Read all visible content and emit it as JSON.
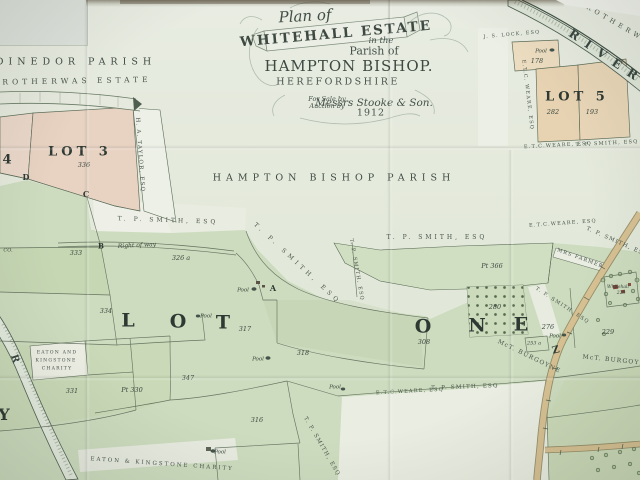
{
  "cartouche": {
    "plan_of": "Plan of",
    "estate_name": "WHITEHALL ESTATE",
    "in_the": "in the",
    "parish_of": "Parish of",
    "parish_name": "HAMPTON BISHOP.",
    "county": "HEREFORDSHIRE",
    "sale_line1": "For Sale by",
    "sale_line2": "Auction by",
    "auctioneers": "Messrs Stooke & Son.",
    "year": "1912"
  },
  "colors": {
    "paper": "#e5ebdf",
    "field_green": "#cddcbf",
    "parcel_pink": "#e8d2c2",
    "parcel_tan": "#e7d3b2",
    "road_tan": "#d7c193",
    "river_edge": "#4e5e50",
    "ink": "#3f4b43",
    "building_red": "#7b4335"
  },
  "labels": [
    {
      "t": "DINEDOR PARISH",
      "x": 76,
      "y": 62,
      "c": "region",
      "n": "dinedor-parish-label"
    },
    {
      "t": "ROTHERWAS ESTATE",
      "x": 77,
      "y": 81,
      "r": -1,
      "c": "estate",
      "n": "rotherwas-estate-label"
    },
    {
      "t": "HAMPTON BISHOP PARISH",
      "x": 334,
      "y": 178,
      "c": "region",
      "n": "hampton-bishop-parish-label"
    },
    {
      "t": "4",
      "x": 9,
      "y": 160,
      "c": "lot",
      "n": "lot-4-number"
    },
    {
      "t": "LOT 3",
      "x": 80,
      "y": 152,
      "c": "lot",
      "n": "lot-3-label"
    },
    {
      "t": "336",
      "x": 84,
      "y": 165,
      "c": "parcel"
    },
    {
      "t": "LOT 5",
      "x": 577,
      "y": 97,
      "c": "lot",
      "n": "lot-5-label"
    },
    {
      "t": "282",
      "x": 553,
      "y": 112,
      "c": "parcel"
    },
    {
      "t": "193",
      "x": 592,
      "y": 112,
      "c": "parcel"
    },
    {
      "t": "178",
      "x": 537,
      "y": 61,
      "c": "parcel"
    },
    {
      "t": "L",
      "x": 128,
      "y": 321,
      "c": "biglet",
      "n": "lot-one-letter"
    },
    {
      "t": "O",
      "x": 178,
      "y": 322,
      "c": "biglet",
      "n": "lot-one-letter"
    },
    {
      "t": "T",
      "x": 223,
      "y": 323,
      "c": "biglet",
      "n": "lot-one-letter"
    },
    {
      "t": "O",
      "x": 423,
      "y": 327,
      "c": "biglet",
      "n": "lot-one-letter"
    },
    {
      "t": "N",
      "x": 477,
      "y": 326,
      "c": "biglet",
      "n": "lot-one-letter"
    },
    {
      "t": "E",
      "x": 521,
      "y": 325,
      "c": "biglet",
      "n": "lot-one-letter"
    },
    {
      "t": "Z",
      "x": 556,
      "y": 351,
      "r": -15,
      "c": "marker",
      "s": 10,
      "n": "letter-marker-z"
    },
    {
      "t": "333",
      "x": 76,
      "y": 253,
      "c": "parcel"
    },
    {
      "t": "326 a",
      "x": 181,
      "y": 258,
      "c": "parcel"
    },
    {
      "t": "334",
      "x": 106,
      "y": 311,
      "c": "parcel"
    },
    {
      "t": "317",
      "x": 245,
      "y": 329,
      "c": "parcel"
    },
    {
      "t": "318",
      "x": 303,
      "y": 353,
      "c": "parcel"
    },
    {
      "t": "Pt 366",
      "x": 492,
      "y": 266,
      "c": "parcel"
    },
    {
      "t": "308",
      "x": 424,
      "y": 342,
      "c": "parcel"
    },
    {
      "t": "280",
      "x": 495,
      "y": 307,
      "c": "parcel"
    },
    {
      "t": "276",
      "x": 548,
      "y": 327,
      "c": "parcel"
    },
    {
      "t": "229",
      "x": 608,
      "y": 332,
      "c": "parcel"
    },
    {
      "t": "253 a",
      "x": 534,
      "y": 344,
      "c": "parcel",
      "s": 5
    },
    {
      "t": "331",
      "x": 72,
      "y": 391,
      "c": "parcel"
    },
    {
      "t": "Pt 330",
      "x": 132,
      "y": 390,
      "c": "parcel"
    },
    {
      "t": "347",
      "x": 188,
      "y": 378,
      "c": "parcel"
    },
    {
      "t": "316",
      "x": 257,
      "y": 420,
      "c": "parcel"
    },
    {
      "t": "228",
      "x": 621,
      "y": 294,
      "c": "parcel",
      "s": 4.5
    },
    {
      "t": "Whitehall",
      "x": 618,
      "y": 288,
      "c": "pool",
      "s": 4.5,
      "n": "whitehall-label"
    },
    {
      "t": "H. A. TAYLOR, ESQ",
      "x": 139,
      "y": 155,
      "r": 86,
      "c": "owner",
      "s": 5.5
    },
    {
      "t": "T. P. SMITH, ESQ",
      "x": 168,
      "y": 221,
      "r": 2,
      "c": "owner",
      "ls": 3
    },
    {
      "t": "T. P. SMITH, ESQ",
      "x": 437,
      "y": 238,
      "c": "owner",
      "ls": 3
    },
    {
      "t": "T. P. SMITH, ESQ",
      "x": 297,
      "y": 264,
      "r": 43,
      "c": "owner",
      "ls": 4
    },
    {
      "t": "T. P. SMITH, ESQ",
      "x": 356,
      "y": 270,
      "r": 80,
      "c": "owner",
      "s": 5
    },
    {
      "t": "E.T.C.WEARE, ESQ",
      "x": 563,
      "y": 224,
      "r": -4,
      "c": "owner",
      "s": 5
    },
    {
      "t": "T. P. SMITH, ESQ",
      "x": 617,
      "y": 243,
      "r": 24,
      "c": "owner",
      "s": 5.5
    },
    {
      "t": "MRS FARMER",
      "x": 580,
      "y": 259,
      "r": 20,
      "c": "owner",
      "s": 5
    },
    {
      "t": "T. P. SMITH, ESQ",
      "x": 562,
      "y": 306,
      "r": 33,
      "c": "owner",
      "s": 5
    },
    {
      "t": "E.T.C. WEARE, ESQ",
      "x": 527,
      "y": 95,
      "r": 83,
      "c": "owner",
      "s": 5
    },
    {
      "t": "E.T.C.WEARE, ESQ",
      "x": 558,
      "y": 146,
      "r": -3,
      "c": "owner",
      "s": 5
    },
    {
      "t": "T. P. SMITH, ESQ",
      "x": 607,
      "y": 144,
      "r": -3,
      "c": "owner",
      "s": 5
    },
    {
      "t": "J. S. LOCK, ESQ",
      "x": 512,
      "y": 36,
      "r": -5,
      "c": "owner",
      "s": 4.8
    },
    {
      "t": "E.T.C.WEARE, ESQ",
      "x": 410,
      "y": 392,
      "r": -3,
      "c": "owner",
      "s": 5
    },
    {
      "t": "T. P. SMITH, ESQ",
      "x": 465,
      "y": 388,
      "r": -2,
      "c": "owner",
      "s": 5.5
    },
    {
      "t": "T. P. SMITH, ESQ",
      "x": 321,
      "y": 447,
      "r": 60,
      "c": "owner",
      "s": 5.5
    },
    {
      "t": "McT. BURGOYNE",
      "x": 529,
      "y": 357,
      "r": 26,
      "c": "owner",
      "s": 6
    },
    {
      "t": "McT. BURGOYNE",
      "x": 617,
      "y": 361,
      "r": 6,
      "c": "owner",
      "s": 6
    },
    {
      "t": "EATON AND",
      "x": 57,
      "y": 354,
      "c": "owner",
      "s": 4.6,
      "n": "charity-owner-label"
    },
    {
      "t": "KINGSTONE",
      "x": 56,
      "y": 362,
      "c": "owner",
      "s": 4.6,
      "n": "charity-owner-label"
    },
    {
      "t": "CHARITY",
      "x": 57,
      "y": 370,
      "c": "owner",
      "s": 4.6,
      "n": "charity-owner-label"
    },
    {
      "t": "EATON & KINGSTONE CHARITY",
      "x": 162,
      "y": 465,
      "r": 4,
      "c": "owner",
      "s": 5.5,
      "ls": 2,
      "n": "charity-owner-label"
    },
    {
      "t": "Right of way",
      "x": 137,
      "y": 246,
      "r": -3,
      "c": "pool",
      "s": 6,
      "n": "right-of-way-label"
    },
    {
      "t": "CO.",
      "x": 8,
      "y": 251,
      "c": "parcel",
      "s": 5,
      "n": "text-fragment"
    },
    {
      "t": "ROTHERWAS",
      "x": 622,
      "y": 27,
      "r": 30,
      "c": "estate",
      "s": 6.5,
      "n": "rotherwas-label"
    },
    {
      "t": "RIVER",
      "x": 607,
      "y": 57,
      "r": 34,
      "c": "rivertxt",
      "n": "river-name-label"
    },
    {
      "t": "R",
      "x": 14,
      "y": 359,
      "r": 72,
      "c": "rivertxt",
      "s": 10,
      "ls": 0,
      "n": "river-letter"
    },
    {
      "t": "Y",
      "x": 4,
      "y": 415,
      "c": "biglet",
      "s": 16,
      "n": "letter-fragment-y"
    },
    {
      "t": "A",
      "x": 273,
      "y": 288,
      "c": "marker",
      "n": "point-marker-a"
    },
    {
      "t": "B",
      "x": 101,
      "y": 246,
      "c": "marker",
      "s": 7,
      "n": "point-marker-b"
    },
    {
      "t": "C",
      "x": 86,
      "y": 194,
      "c": "marker",
      "n": "point-marker-c"
    },
    {
      "t": "D",
      "x": 26,
      "y": 177,
      "c": "marker",
      "n": "point-marker-d"
    },
    {
      "t": "Pool",
      "x": 541,
      "y": 52,
      "c": "pool"
    },
    {
      "t": "Pool",
      "x": 243,
      "y": 291,
      "c": "pool"
    },
    {
      "t": "Pool",
      "x": 206,
      "y": 317,
      "c": "pool"
    },
    {
      "t": "Pool",
      "x": 258,
      "y": 360,
      "c": "pool"
    },
    {
      "t": "Pool",
      "x": 335,
      "y": 388,
      "c": "pool"
    },
    {
      "t": "Pool",
      "x": 220,
      "y": 453,
      "c": "pool"
    },
    {
      "t": "Pool",
      "x": 555,
      "y": 337,
      "c": "pool"
    }
  ]
}
